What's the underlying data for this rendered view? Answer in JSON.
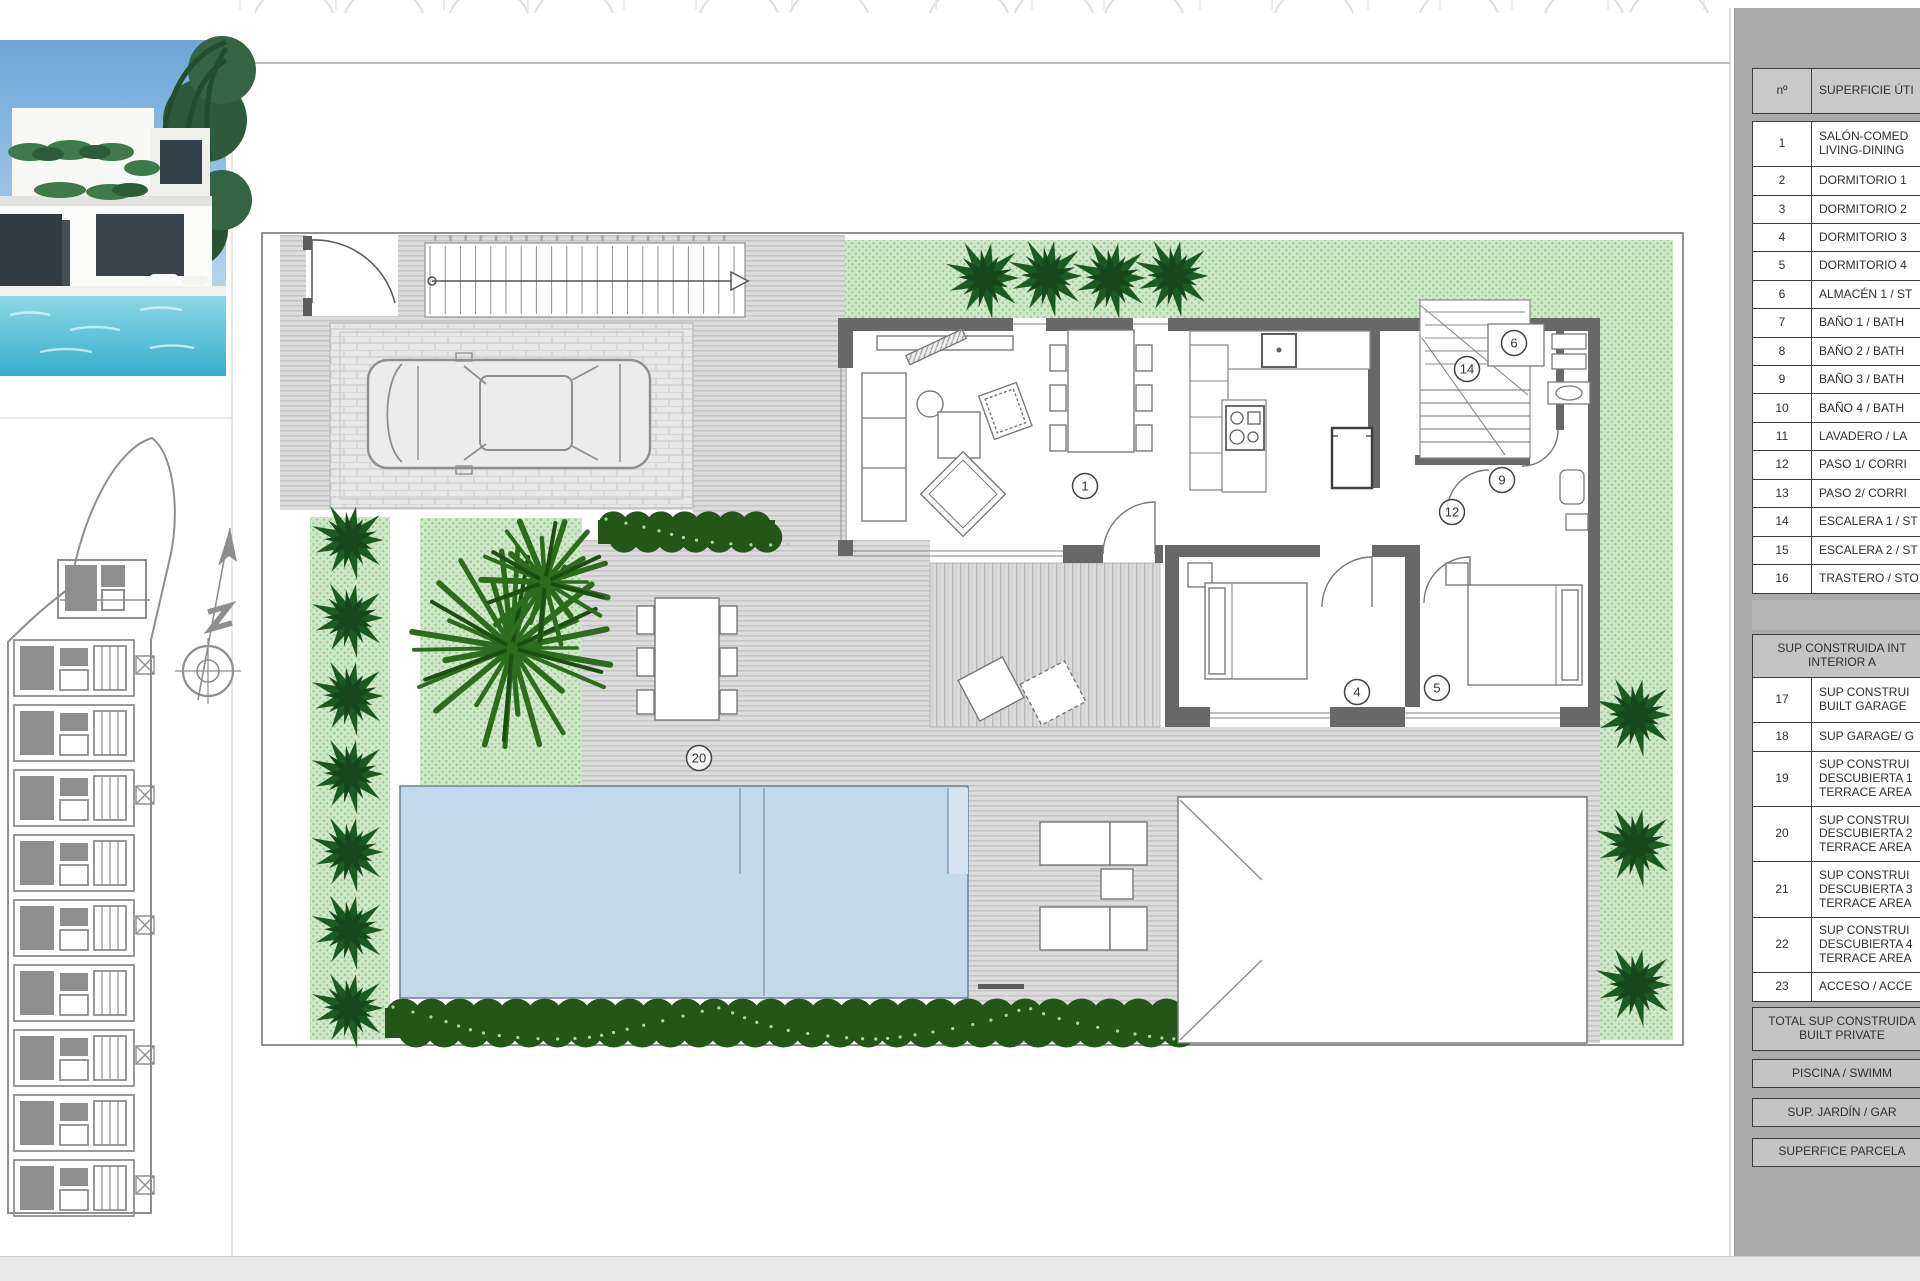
{
  "page": {
    "background": "#ffffff",
    "panel_gray": "#ababab",
    "bottom_bar_gray": "#e9e9e9"
  },
  "photo": {
    "description": "villa-exterior-render",
    "sky_color": "#8fb9e3",
    "pool_color": "#49b8d2"
  },
  "compass": {
    "icon": "north-arrow"
  },
  "floor_plan": {
    "colors": {
      "lawn": "#cfe9c8",
      "paving": "#dcdcdc",
      "pool": "#c2d8eb",
      "wall": "#686868",
      "bush_green": "#1d5a1f",
      "hedge_green": "#235618",
      "palm_gray": "#9c9c9c",
      "palm_green": "#2e6b1e"
    },
    "room_markers": [
      {
        "label": "1",
        "x": 1085,
        "y": 486
      },
      {
        "label": "4",
        "x": 1357,
        "y": 692
      },
      {
        "label": "5",
        "x": 1437,
        "y": 688
      },
      {
        "label": "6",
        "x": 1514,
        "y": 343
      },
      {
        "label": "9",
        "x": 1502,
        "y": 480
      },
      {
        "label": "12",
        "x": 1452,
        "y": 512
      },
      {
        "label": "14",
        "x": 1467,
        "y": 369
      },
      {
        "label": "20",
        "x": 699,
        "y": 758
      }
    ]
  },
  "table": {
    "header": {
      "num": "nº",
      "label": "SUPERFICIE ÚTI"
    },
    "rows": [
      {
        "num": "1",
        "lines": [
          "SALÓN-COMED",
          "LIVING-DINING"
        ]
      },
      {
        "num": "2",
        "lines": [
          "DORMITORIO 1"
        ]
      },
      {
        "num": "3",
        "lines": [
          "DORMITORIO 2"
        ]
      },
      {
        "num": "4",
        "lines": [
          "DORMITORIO 3"
        ]
      },
      {
        "num": "5",
        "lines": [
          "DORMITORIO 4"
        ]
      },
      {
        "num": "6",
        "lines": [
          "ALMACÉN 1 / ST"
        ]
      },
      {
        "num": "7",
        "lines": [
          "BAÑO 1 / BATH"
        ]
      },
      {
        "num": "8",
        "lines": [
          "BAÑO 2 / BATH"
        ]
      },
      {
        "num": "9",
        "lines": [
          "BAÑO 3 / BATH"
        ]
      },
      {
        "num": "10",
        "lines": [
          "BAÑO 4 / BATH"
        ]
      },
      {
        "num": "11",
        "lines": [
          "LAVADERO / LA"
        ]
      },
      {
        "num": "12",
        "lines": [
          "PASO 1/ CORRI"
        ]
      },
      {
        "num": "13",
        "lines": [
          "PASO 2/ CORRI"
        ]
      },
      {
        "num": "14",
        "lines": [
          "ESCALERA 1 / ST"
        ]
      },
      {
        "num": "15",
        "lines": [
          "ESCALERA 2 / ST"
        ]
      },
      {
        "num": "16",
        "lines": [
          "TRASTERO / STO"
        ]
      },
      {
        "num": "17",
        "lines": [
          "SUP CONSTRUI",
          "BUILT GARAGE"
        ]
      },
      {
        "num": "18",
        "lines": [
          "SUP GARAGE/ G"
        ]
      },
      {
        "num": "19",
        "lines": [
          "SUP CONSTRUI",
          "DESCUBIERTA 1",
          "TERRACE AREA"
        ]
      },
      {
        "num": "20",
        "lines": [
          "SUP CONSTRUI",
          "DESCUBIERTA 2",
          "TERRACE AREA"
        ]
      },
      {
        "num": "21",
        "lines": [
          "SUP CONSTRUI",
          "DESCUBIERTA 3",
          "TERRACE AREA"
        ]
      },
      {
        "num": "22",
        "lines": [
          "SUP CONSTRUI",
          "DESCUBIERTA 4",
          "TERRACE AREA"
        ]
      },
      {
        "num": "23",
        "lines": [
          "ACCESO / ACCE"
        ]
      }
    ],
    "section_header": {
      "lines": [
        "SUP CONSTRUIDA INT",
        "INTERIOR A"
      ]
    },
    "totals": [
      {
        "lines": [
          "TOTAL SUP CONSTRUIDA",
          "BUILT PRIVATE"
        ]
      },
      {
        "lines": [
          "PISCINA / SWIMM"
        ]
      },
      {
        "lines": [
          "SUP. JARDÍN / GAR"
        ]
      },
      {
        "lines": [
          "SUPERFICE PARCELA"
        ]
      }
    ]
  }
}
